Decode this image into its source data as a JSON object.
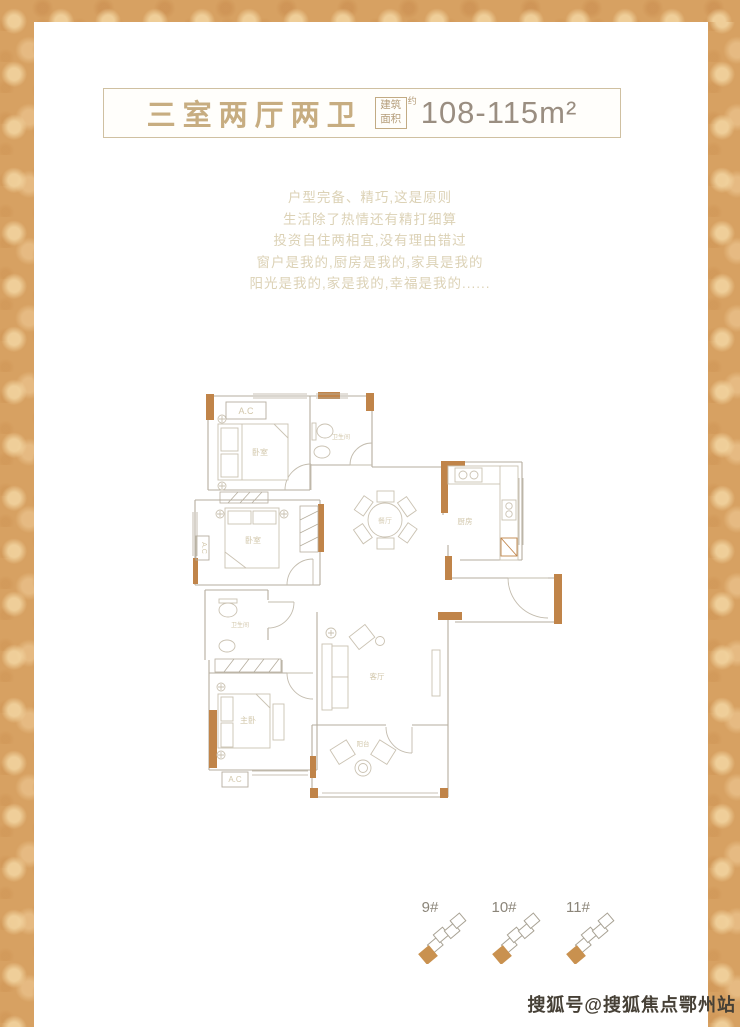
{
  "header": {
    "title": "三室两厅两卫",
    "area_box_top": "建筑",
    "area_box_bottom": "面积",
    "area_approx": "约",
    "area_value": "108-115m²"
  },
  "poem": {
    "lines": [
      "户型完备、精巧,这是原则",
      "生活除了热情还有精打细算",
      "投资自住两相宜,没有理由错过",
      "窗户是我的,厨房是我的,家具是我的",
      "阳光是我的,家是我的,幸福是我的......"
    ]
  },
  "floorplan": {
    "ac_label": "A.C",
    "rooms": [
      {
        "name": "bedroom-top",
        "label": "卧室"
      },
      {
        "name": "bathroom-top",
        "label": "卫生间"
      },
      {
        "name": "dining-room",
        "label": "餐厅"
      },
      {
        "name": "kitchen",
        "label": "厨房"
      },
      {
        "name": "bedroom-middle",
        "label": "卧室"
      },
      {
        "name": "bathroom-middle",
        "label": "卫生间"
      },
      {
        "name": "master-bedroom",
        "label": "主卧"
      },
      {
        "name": "living-room",
        "label": "客厅"
      },
      {
        "name": "balcony",
        "label": "阳台"
      }
    ]
  },
  "buildings": [
    {
      "label": "9#"
    },
    {
      "label": "10#"
    },
    {
      "label": "11#"
    }
  ],
  "page": {
    "watermark": "搜狐号@搜狐焦点鄂州站"
  },
  "colors": {
    "frame_gold": "#d7a162",
    "title_text": "#c7ad81",
    "area_text": "#9a8e81",
    "poem_text": "#dcd2b6",
    "wall_line": "#b6ae9f",
    "wall_accent": "#c08449",
    "label_text": "#d2c7ab",
    "watermark_text": "#464036"
  }
}
